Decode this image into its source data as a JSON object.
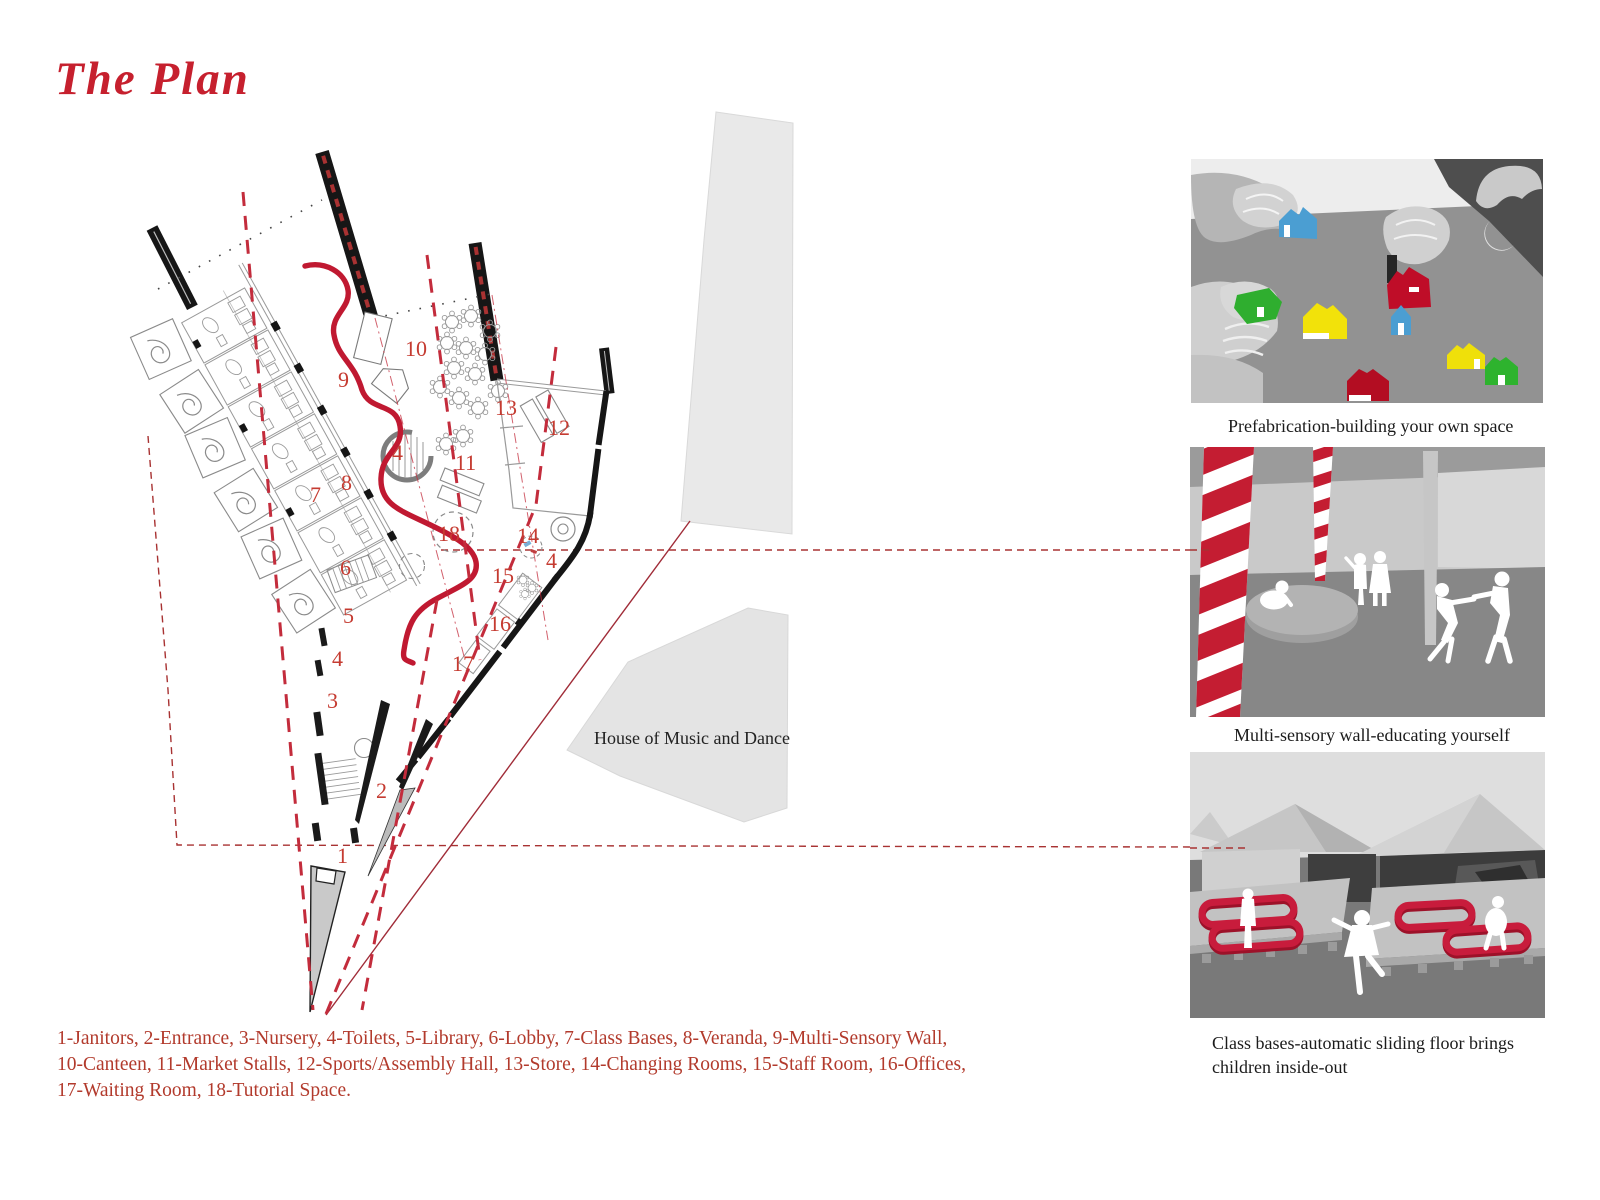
{
  "title": "The Plan",
  "palette": {
    "accent_red": "#c32132",
    "serpentine_red": "#c01931",
    "dash_red": "#b33732",
    "number_red": "#c53b31",
    "legend_red": "#b23a2c",
    "ink_black": "#1b1b1b",
    "wall_black": "#161616",
    "site_gray": "#e7e7e7"
  },
  "plan": {
    "house_label": "House of Music and Dance",
    "labels": [
      "1",
      "2",
      "3",
      "4",
      "4",
      "4",
      "5",
      "6",
      "7",
      "8",
      "9",
      "10",
      "11",
      "12",
      "13",
      "14",
      "15",
      "16",
      "17",
      "18"
    ]
  },
  "figures": [
    {
      "caption": "Prefabrication-building your own space"
    },
    {
      "caption": "Multi-sensory wall-educating yourself"
    },
    {
      "caption": "Class bases-automatic sliding floor brings children inside-out"
    }
  ],
  "legend": {
    "lines": [
      "1-Janitors, 2-Entrance, 3-Nursery, 4-Toilets, 5-Library, 6-Lobby, 7-Class Bases, 8-Veranda, 9-Multi-Sensory Wall,",
      "10-Canteen, 11-Market Stalls, 12-Sports/Assembly Hall, 13-Store, 14-Changing Rooms, 15-Staff Room, 16-Offices,",
      "17-Waiting Room, 18-Tutorial Space."
    ]
  }
}
